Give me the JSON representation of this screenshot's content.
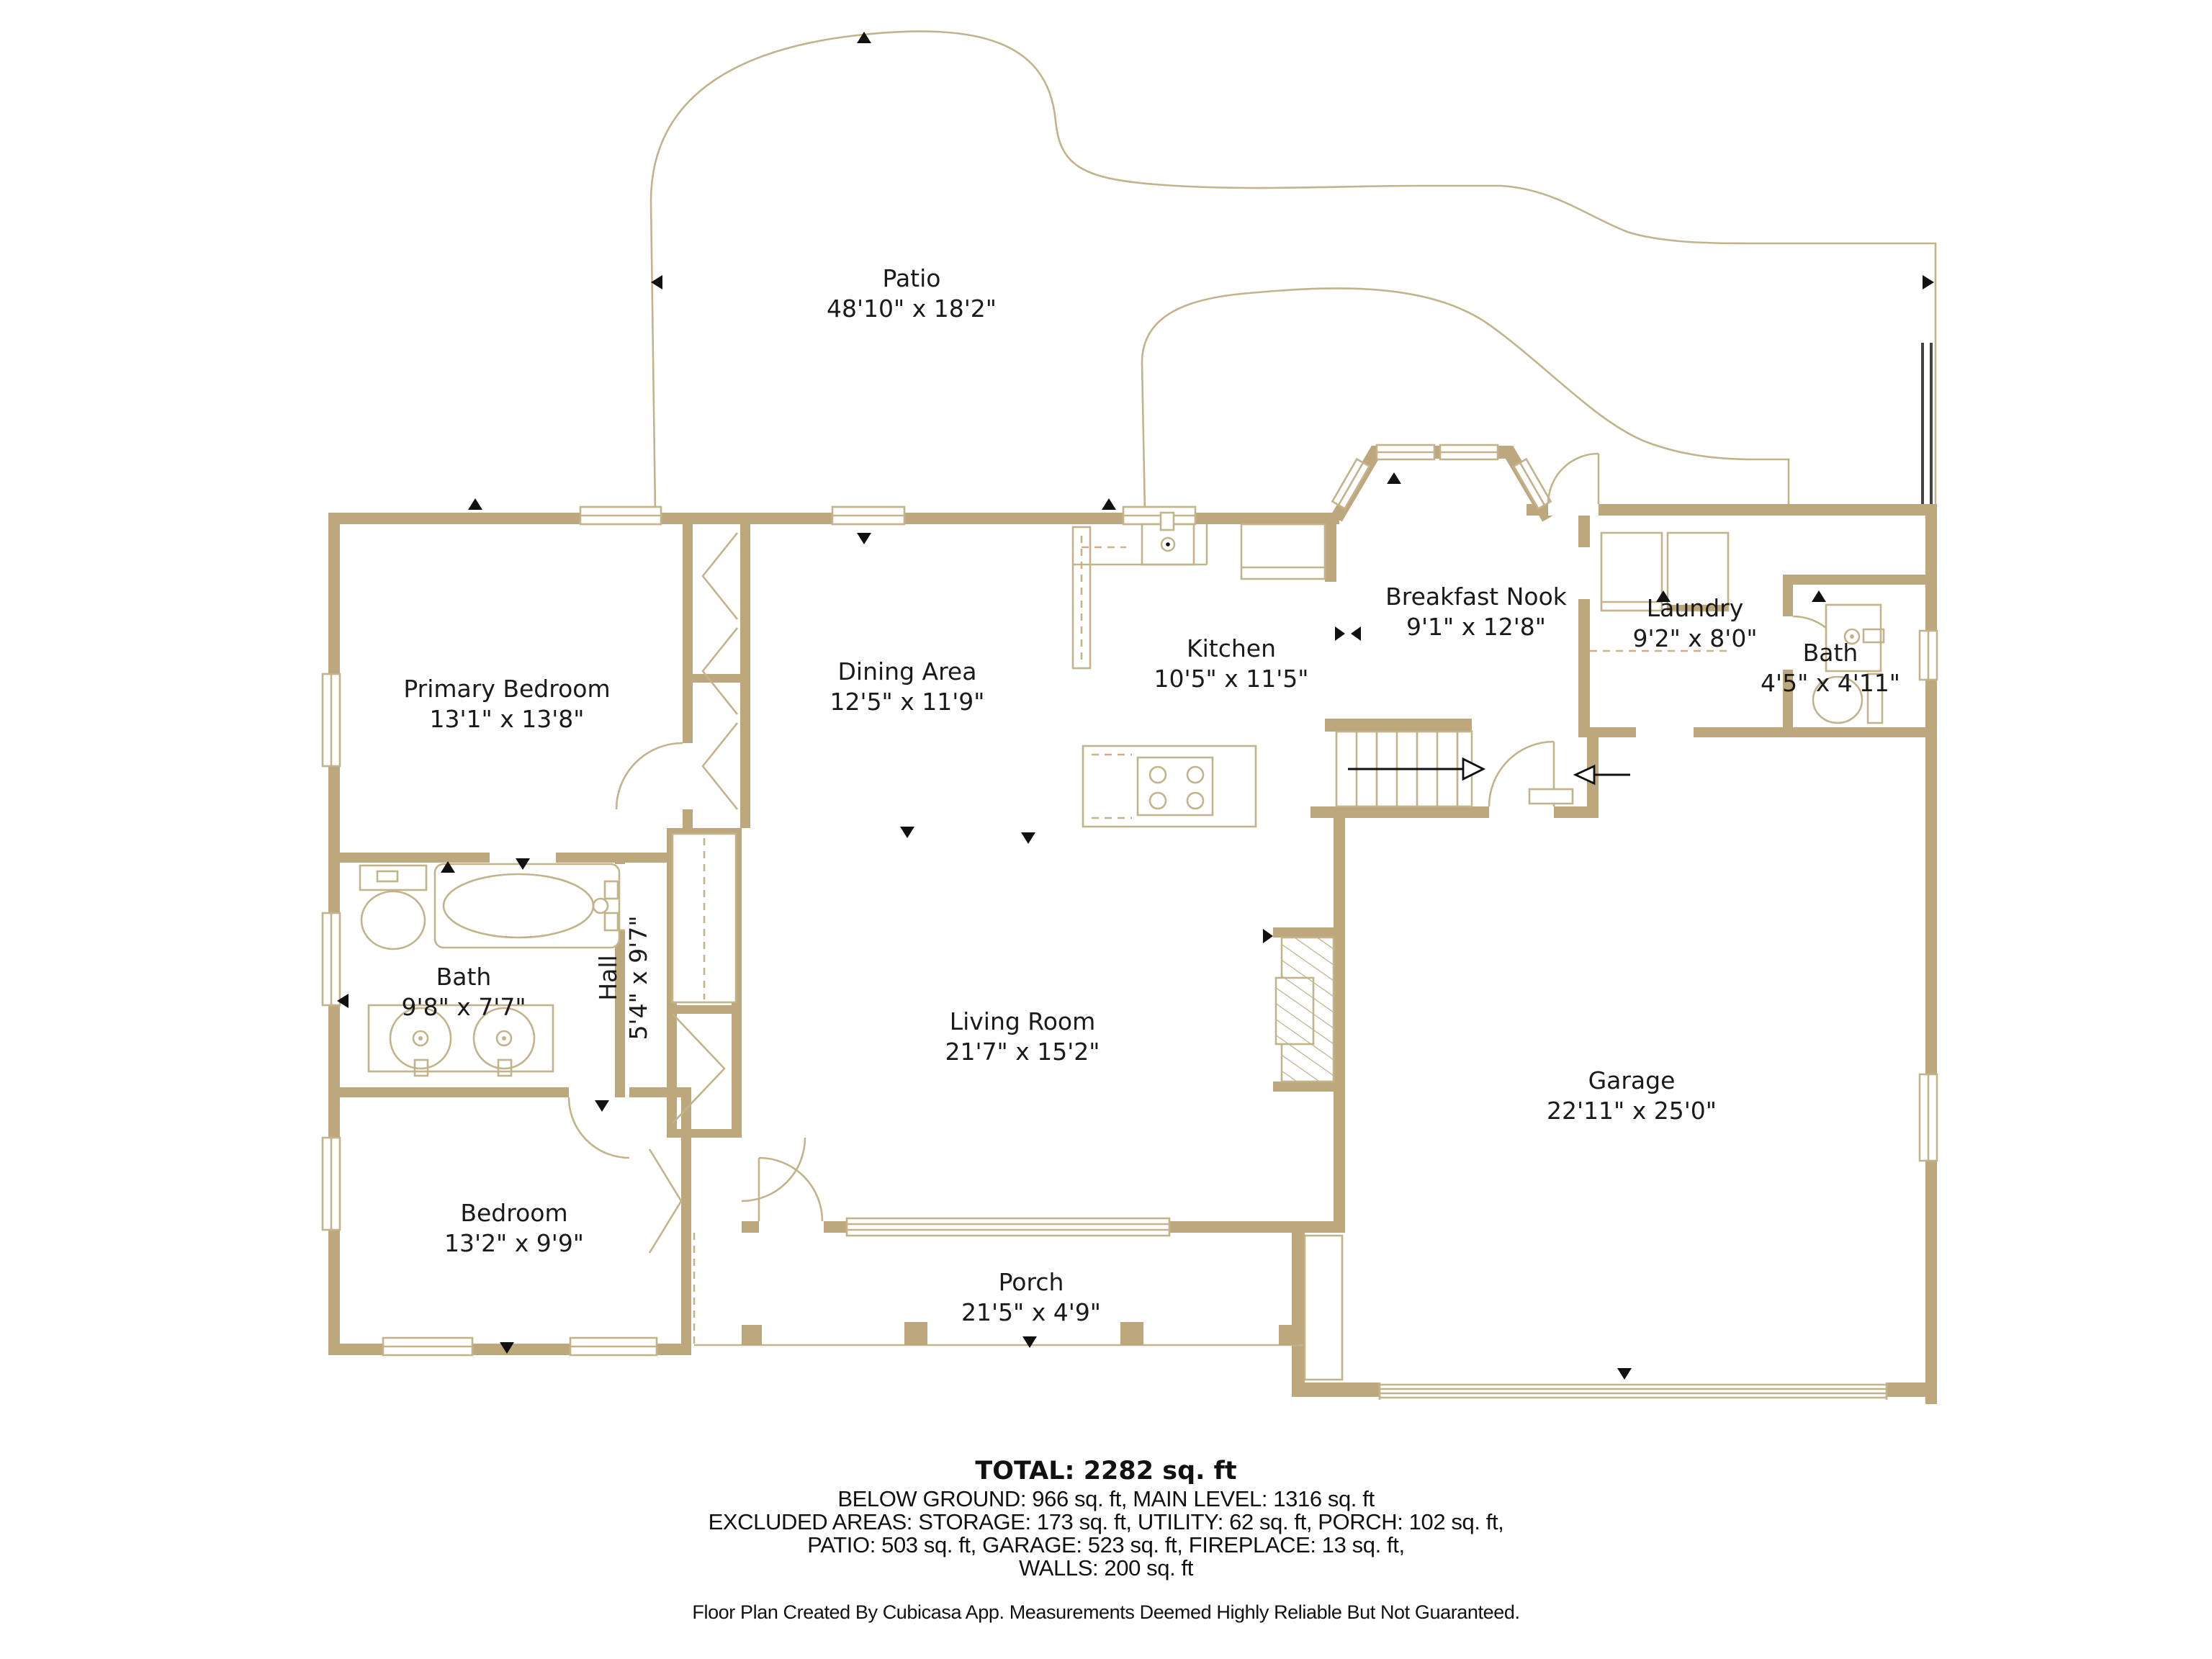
{
  "rooms": [
    {
      "name": "Patio",
      "dimensions": "48'10\" x 18'2\""
    },
    {
      "name": "Primary Bedroom",
      "dimensions": "13'1\" x 13'8\""
    },
    {
      "name": "Dining Area",
      "dimensions": "12'5\" x 11'9\""
    },
    {
      "name": "Kitchen",
      "dimensions": "10'5\" x 11'5\""
    },
    {
      "name": "Breakfast Nook",
      "dimensions": "9'1\" x 12'8\""
    },
    {
      "name": "Laundry",
      "dimensions": "9'2\" x 8'0\""
    },
    {
      "name": "Bath",
      "dimensions": "4'5\" x 4'11\""
    },
    {
      "name": "Bath",
      "dimensions": "9'8\" x 7'7\""
    },
    {
      "name": "Hall",
      "dimensions": "5'4\" x 9'7\""
    },
    {
      "name": "Living Room",
      "dimensions": "21'7\" x 15'2\""
    },
    {
      "name": "Garage",
      "dimensions": "22'11\" x 25'0\""
    },
    {
      "name": "Bedroom",
      "dimensions": "13'2\" x 9'9\""
    },
    {
      "name": "Porch",
      "dimensions": "21'5\" x 4'9\""
    }
  ],
  "summary": {
    "total": "TOTAL: 2282 sq. ft",
    "lines": [
      "BELOW GROUND: 966 sq. ft, MAIN LEVEL: 1316 sq. ft",
      "EXCLUDED AREAS: STORAGE: 173 sq. ft, UTILITY: 62 sq. ft, PORCH: 102 sq. ft,",
      "PATIO: 503 sq. ft, GARAGE: 523 sq. ft, FIREPLACE: 13 sq. ft,",
      "WALLS: 200 sq. ft"
    ]
  },
  "footer": {
    "text": "Floor Plan Created By Cubicasa App. Measurements Deemed Highly Reliable But Not Guaranteed."
  },
  "colors": {
    "wall": "#bda87d",
    "thin_line": "#c2b38b",
    "marker": "#111111",
    "text": "#1a1a1a",
    "patio_fence": "#444444",
    "background": "#ffffff"
  }
}
